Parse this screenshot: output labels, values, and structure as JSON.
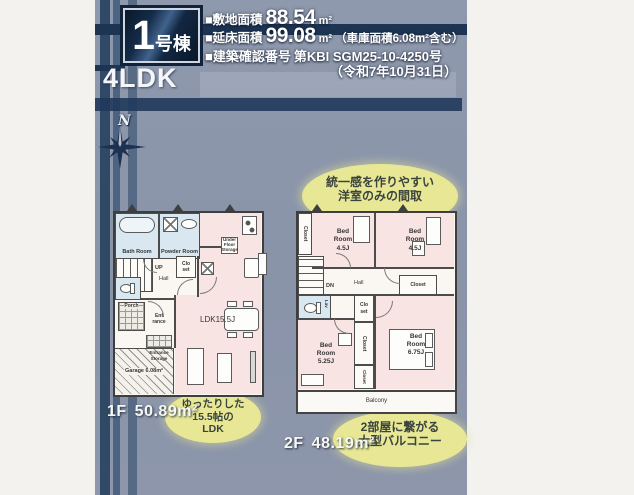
{
  "colors": {
    "panel": "#8d96aa",
    "navy": "#1d3553",
    "callout_yellow": "#e7e795",
    "room_pink": "#f8e4e2",
    "room_blue": "#d9e8f0"
  },
  "header": {
    "building_number": "1",
    "building_suffix": "号棟",
    "plan_type": "4LDK",
    "site_area_label": "■敷地面積",
    "site_area_value": "88.54",
    "site_area_unit": "m²",
    "total_area_label": "■延床面積",
    "total_area_value": "99.08",
    "total_area_unit": "m²",
    "total_area_note": "（車庫面積6.08m²含む）",
    "permit_label": "■建築確認番号",
    "permit_number": "第KBI SGM25-10-4250号",
    "permit_date": "（令和7年10月31日）"
  },
  "compass": {
    "north": "N"
  },
  "floor1": {
    "label": "1F",
    "area": "50.89m²",
    "callout": {
      "l1": "ゆったりした",
      "l2": "15.5帖の",
      "l3": "LDK"
    },
    "rooms": {
      "bath": "Bath Room",
      "powder": "Powder Room",
      "up": "UP",
      "hall": "Hall",
      "closet": "Clo set",
      "under_floor_storage": "Under Floor Storage",
      "ldk": "LDK15.5J",
      "porch": "Porch",
      "entrance": "Ent rance",
      "entrance_storage": "Entrance Storage",
      "garage": "Garage 6.08m²"
    }
  },
  "floor2": {
    "label": "2F",
    "area": "48.19m²",
    "callout_top": {
      "l1": "統一感を作りやすい",
      "l2": "洋室のみの間取"
    },
    "callout_bottom": {
      "l1": "2部屋に繋がる",
      "l2": "大型バルコニー"
    },
    "rooms": {
      "closet_nw": "Closet",
      "bed1": "Bed Room 4.5J",
      "bed2": "Bed Room 4.5J",
      "dn": "DN",
      "hall": "Hall",
      "closet_ne": "Closet",
      "lav": "Lav",
      "closet_mid": "Clo set",
      "closet_c1": "Closet",
      "closet_c2": "Closet",
      "bed3": "Bed Room 5.25J",
      "bed4": "Bed Room 6.75J",
      "balcony": "Balcony"
    }
  }
}
